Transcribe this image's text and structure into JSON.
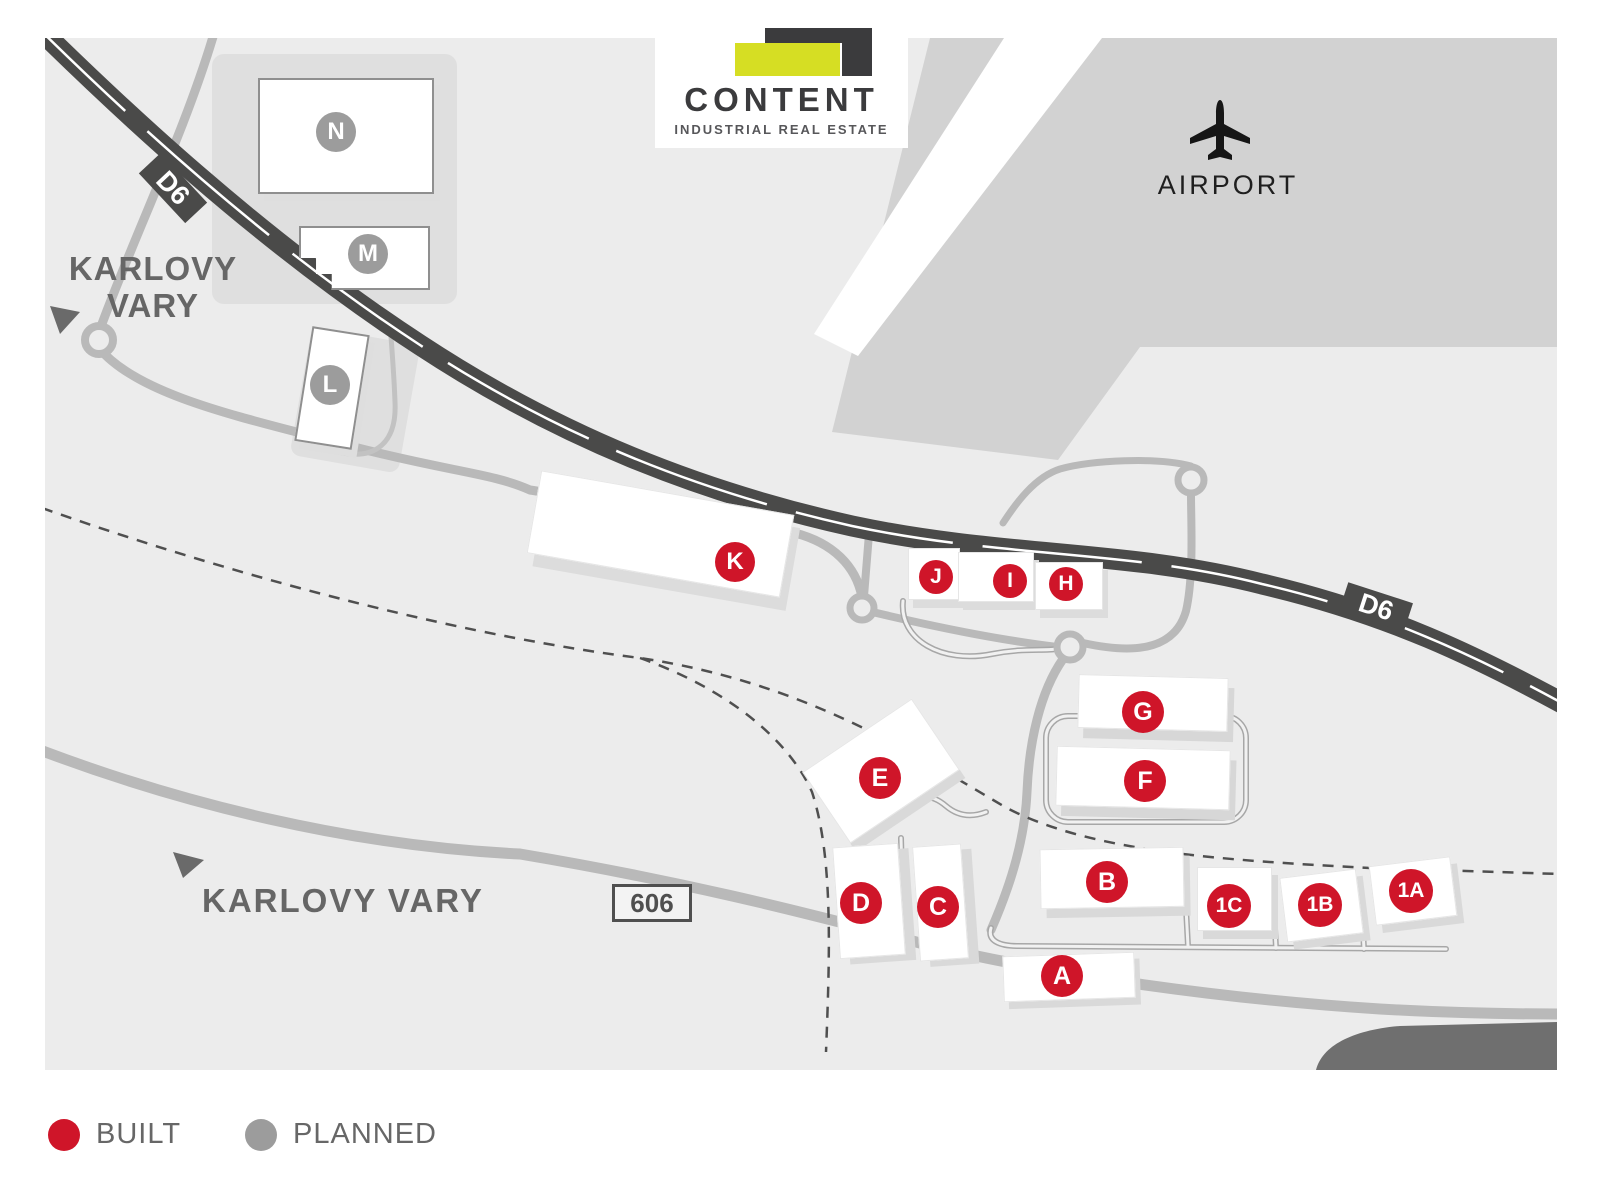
{
  "logo": {
    "title": "CONTENT",
    "subtitle": "INDUSTRIAL REAL ESTATE"
  },
  "map_labels": {
    "airport": "AIRPORT",
    "city_top_line1": "KARLOVY",
    "city_top_line2": "VARY",
    "city_bottom": "KARLOVY VARY",
    "highway": "D6",
    "road_number": "606"
  },
  "legend": {
    "built_label": "BUILT",
    "planned_label": "PLANNED",
    "built_color": "#cf1529",
    "planned_color": "#9c9c9c"
  },
  "buildings": {
    "n": {
      "label": "N",
      "status": "planned"
    },
    "m": {
      "label": "M",
      "status": "planned"
    },
    "l": {
      "label": "L",
      "status": "planned"
    },
    "k": {
      "label": "K",
      "status": "built"
    },
    "j": {
      "label": "J",
      "status": "built"
    },
    "i": {
      "label": "I",
      "status": "built"
    },
    "h": {
      "label": "H",
      "status": "built"
    },
    "g": {
      "label": "G",
      "status": "built"
    },
    "f": {
      "label": "F",
      "status": "built"
    },
    "e": {
      "label": "E",
      "status": "built"
    },
    "d": {
      "label": "D",
      "status": "built"
    },
    "c": {
      "label": "C",
      "status": "built"
    },
    "b": {
      "label": "B",
      "status": "built"
    },
    "a": {
      "label": "A",
      "status": "built"
    },
    "c1": {
      "label": "1C",
      "status": "built"
    },
    "b1": {
      "label": "1B",
      "status": "built"
    },
    "a1": {
      "label": "1A",
      "status": "built"
    }
  },
  "colors": {
    "built": "#cf1529",
    "planned": "#9c9c9c",
    "highway": "#4a4a49",
    "road": "#b9b9b9",
    "airport_area": "#d2d2d2",
    "map_background": "#ececec",
    "logo_yellow": "#d6de23",
    "logo_dark": "#3b3b3d",
    "text_gray": "#666666"
  }
}
